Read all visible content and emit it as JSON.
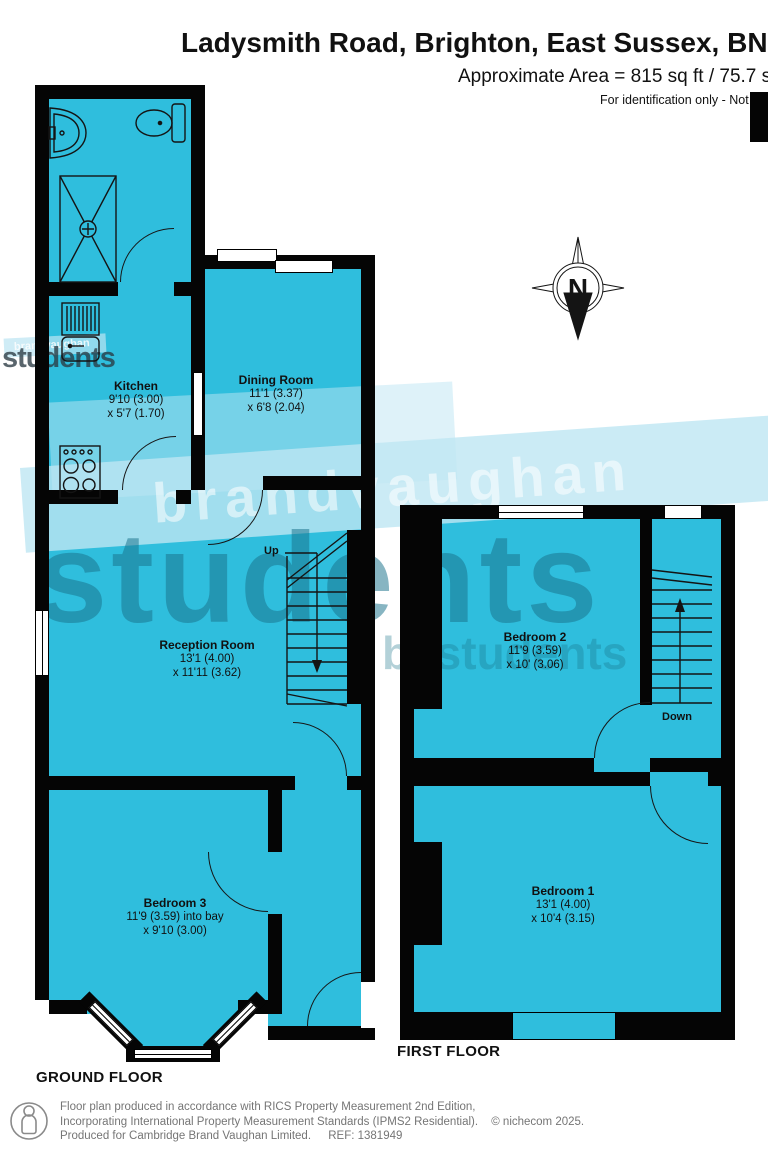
{
  "header": {
    "title": "Ladysmith Road, Brighton, East Sussex, BN2",
    "area_line": "Approximate Area = 815 sq ft / 75.7 sq m",
    "disclaimer": "For identification only - Not to scale"
  },
  "compass": {
    "north_label": "N"
  },
  "watermark": {
    "brand": "brandvaughan",
    "main": "students",
    "secondary": "bvstudents",
    "small_brand": "brandvaughan",
    "small_main": "students"
  },
  "floors": {
    "ground": {
      "label": "GROUND FLOOR",
      "stairs_label": "Up",
      "rooms": [
        {
          "name": "Kitchen",
          "dim1": "9'10 (3.00)",
          "dim2": "x 5'7 (1.70)"
        },
        {
          "name": "Dining Room",
          "dim1": "11'1 (3.37)",
          "dim2": "x 6'8 (2.04)"
        },
        {
          "name": "Reception Room",
          "dim1": "13'1 (4.00)",
          "dim2": "x 11'11 (3.62)"
        },
        {
          "name": "Bedroom 3",
          "dim1": "11'9 (3.59) into bay",
          "dim2": "x 9'10 (3.00)"
        }
      ]
    },
    "first": {
      "label": "FIRST FLOOR",
      "stairs_label": "Down",
      "rooms": [
        {
          "name": "Bedroom 2",
          "dim1": "11'9 (3.59)",
          "dim2": "x 10' (3.06)"
        },
        {
          "name": "Bedroom 1",
          "dim1": "13'1 (4.00)",
          "dim2": "x 10'4 (3.15)"
        }
      ]
    }
  },
  "footer": {
    "line1": "Floor plan produced in accordance with RICS Property Measurement 2nd Edition,",
    "line2": "Incorporating International Property Measurement Standards (IPMS2 Residential).",
    "copyright": "© nichecom 2025.",
    "line3": "Produced for Cambridge Brand Vaughan Limited.",
    "ref": "REF:  1381949"
  },
  "colors": {
    "room_fill": "#2fbedd",
    "wall": "#050505",
    "watermark_teal": "#18728a"
  }
}
